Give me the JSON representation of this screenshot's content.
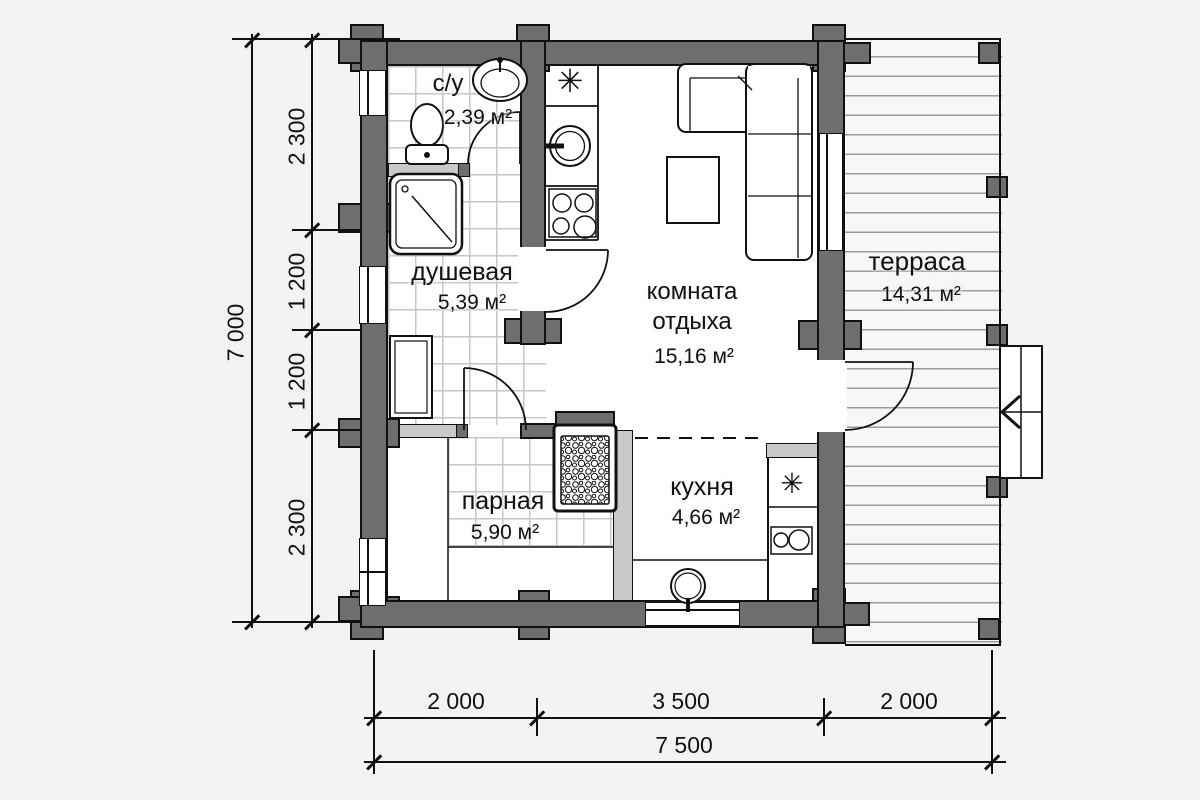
{
  "title": "floor-plan",
  "rooms": {
    "bathroom": {
      "name": "с/у",
      "area": "2,39 м²"
    },
    "shower": {
      "name": "душевая",
      "area": "5,39 м²"
    },
    "lounge": {
      "name_line1": "комната",
      "name_line2": "отдыха",
      "area": "15,16 м²"
    },
    "kitchen": {
      "name": "кухня",
      "area": "4,66 м²"
    },
    "sauna": {
      "name": "парная",
      "area": "5,90 м²"
    },
    "terrace": {
      "name": "терраса",
      "area": "14,31 м²"
    }
  },
  "dimensions": {
    "left_total": "7 000",
    "left_segments": [
      "2 300",
      "1 200",
      "1 200",
      "2 300"
    ],
    "bottom_segments": [
      "2 000",
      "3 500",
      "2 000"
    ],
    "bottom_total": "7 500"
  },
  "symbols": {
    "fridge": "✳"
  },
  "colors": {
    "wall": "#6e6e6e",
    "partition": "#c9c9c9",
    "background": "#f3f3f3",
    "line": "#111111",
    "tile": "#c6c6c6",
    "deck": "#9b9b9b"
  }
}
